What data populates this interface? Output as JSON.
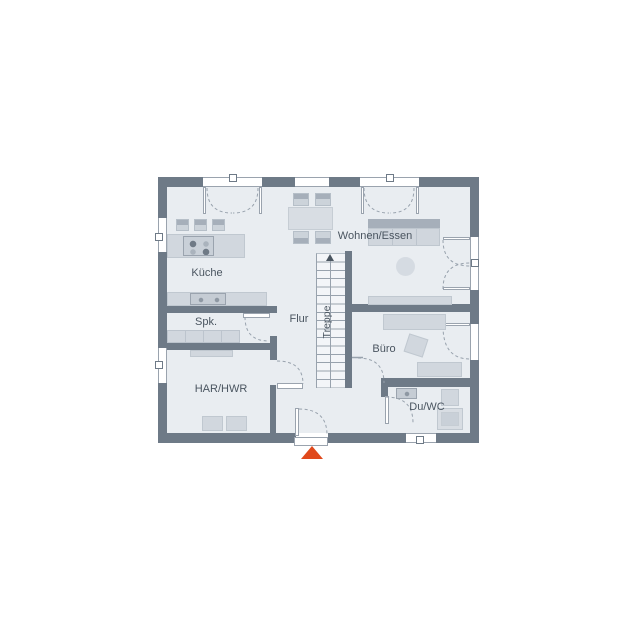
{
  "plan": {
    "rooms": [
      {
        "id": "kueche",
        "label": "Küche"
      },
      {
        "id": "spk",
        "label": "Spk."
      },
      {
        "id": "flur",
        "label": "Flur"
      },
      {
        "id": "har_hwr",
        "label": "HAR/HWR"
      },
      {
        "id": "treppe",
        "label": "Treppe"
      },
      {
        "id": "wohnen_essen",
        "label": "Wohnen/Essen"
      },
      {
        "id": "buero",
        "label": "Büro"
      },
      {
        "id": "du_wc",
        "label": "Du/WC"
      }
    ],
    "colors": {
      "background": "#ffffff",
      "wall": "#6e7a87",
      "floor": "#e9edf1",
      "furniture_light": "#d1d7de",
      "furniture_dark": "#a6afba",
      "door_arc": "#98a2ad",
      "text": "#4a5560",
      "entrance_marker": "#e0491c"
    },
    "icons": {
      "entrance_marker": "triangle-up",
      "stairs_direction": "arrow-up"
    }
  }
}
